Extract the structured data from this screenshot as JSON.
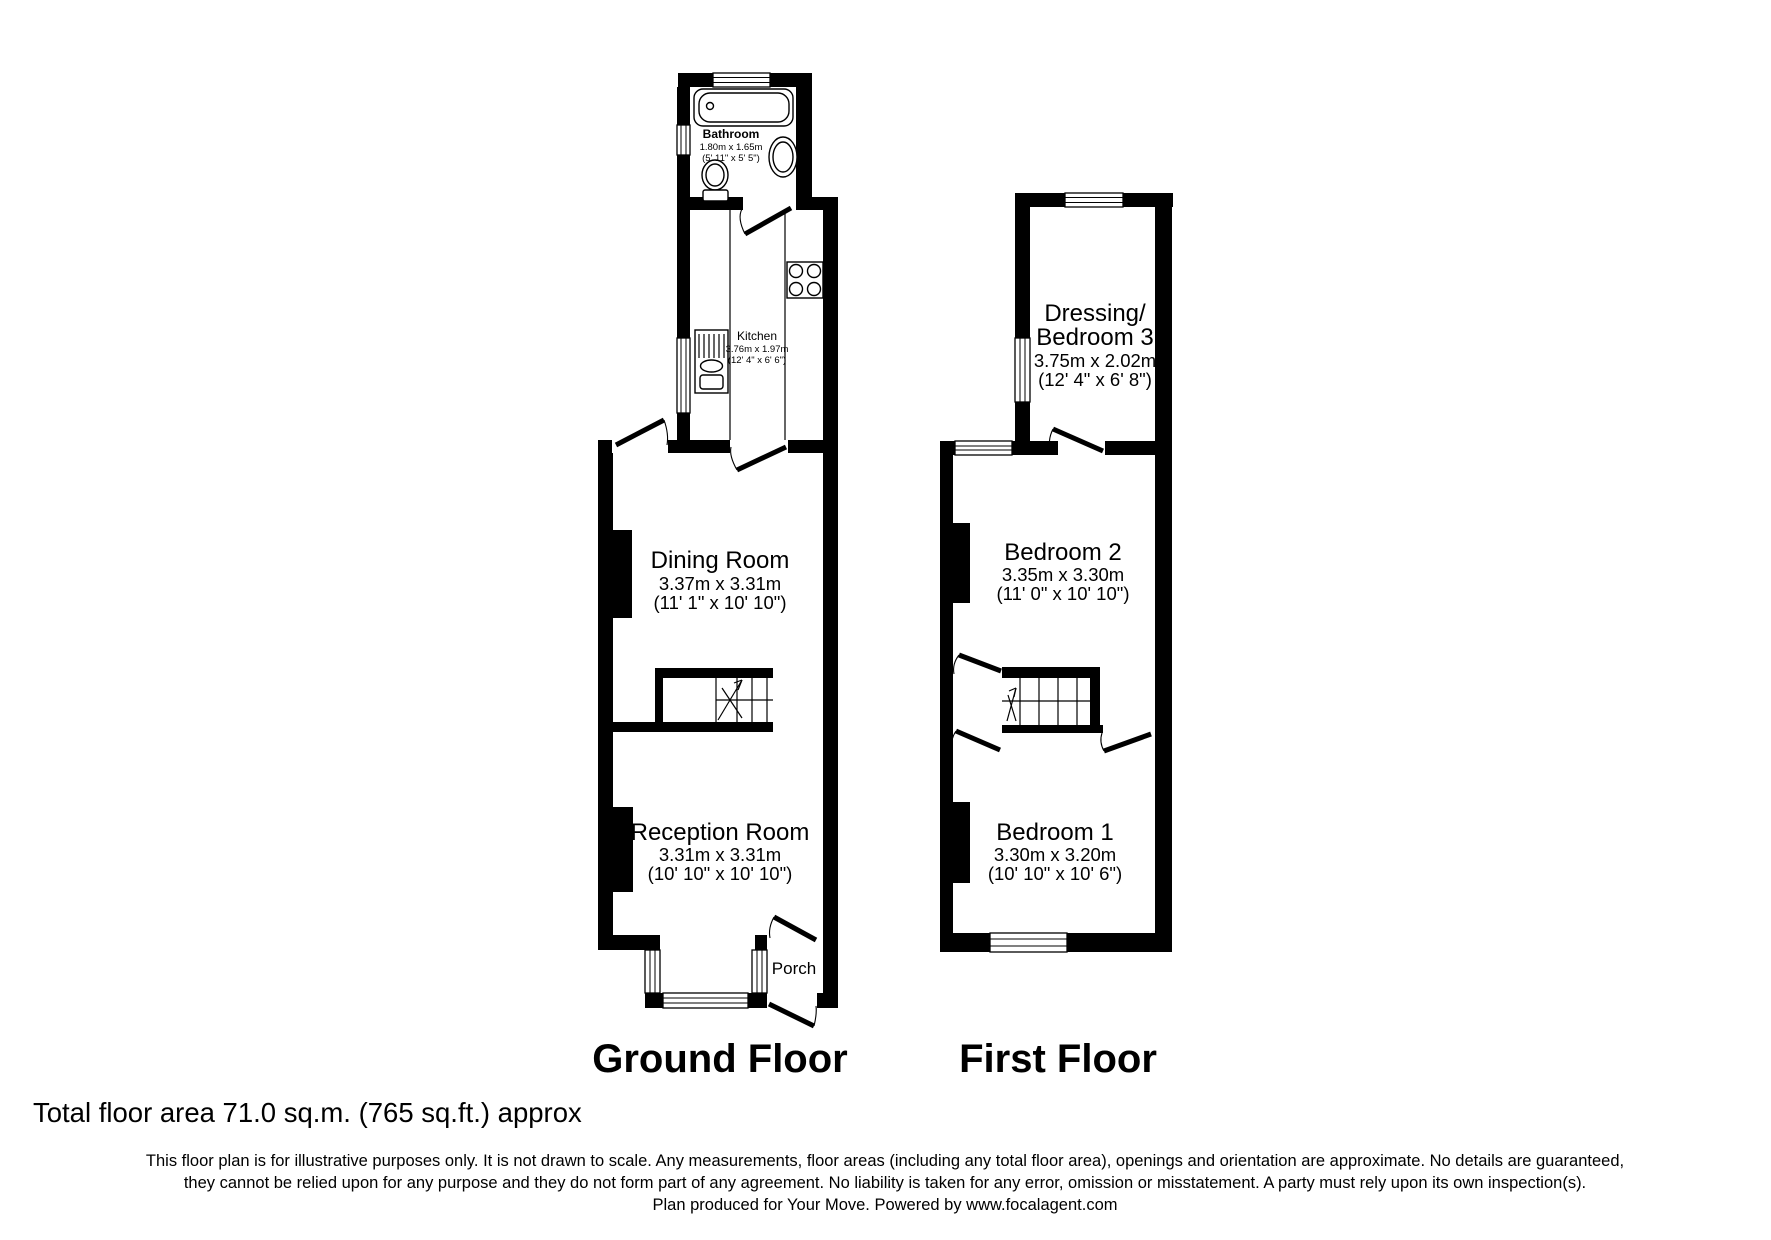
{
  "palette": {
    "wall_color": "#000000",
    "background": "#ffffff"
  },
  "ground_floor": {
    "title": "Ground Floor",
    "rooms": {
      "bathroom": {
        "name": "Bathroom",
        "metric": "1.80m x 1.65m",
        "imperial": "(5' 11\" x 5' 5\")"
      },
      "kitchen": {
        "name": "Kitchen",
        "metric": "3.76m x 1.97m",
        "imperial": "(12' 4\" x 6' 6\")"
      },
      "dining": {
        "name": "Dining Room",
        "metric": "3.37m x 3.31m",
        "imperial": "(11' 1\" x 10' 10\")"
      },
      "reception": {
        "name": "Reception Room",
        "metric": "3.31m x 3.31m",
        "imperial": "(10' 10\" x 10' 10\")"
      },
      "porch": {
        "name": "Porch"
      }
    }
  },
  "first_floor": {
    "title": "First Floor",
    "rooms": {
      "dressing": {
        "name_line1": "Dressing/",
        "name_line2": "Bedroom 3",
        "metric": "3.75m x 2.02m",
        "imperial": "(12' 4\" x 6' 8\")"
      },
      "bedroom2": {
        "name": "Bedroom 2",
        "metric": "3.35m x 3.30m",
        "imperial": "(11' 0\" x 10' 10\")"
      },
      "bedroom1": {
        "name": "Bedroom 1",
        "metric": "3.30m x 3.20m",
        "imperial": "(10' 10\" x 10' 6\")"
      }
    }
  },
  "footer": {
    "total_area": "Total floor area 71.0 sq.m. (765 sq.ft.) approx",
    "disclaimer_line1": "This floor plan is for illustrative purposes only. It is not drawn to scale. Any measurements, floor areas (including any total floor area), openings and orientation are approximate. No details are guaranteed,",
    "disclaimer_line2": "they cannot be relied upon for any purpose and they do not form part of any agreement. No liability is taken for any error, omission or misstatement. A party must rely upon its own inspection(s).",
    "disclaimer_line3": "Plan produced for Your Move. Powered by www.focalagent.com"
  }
}
